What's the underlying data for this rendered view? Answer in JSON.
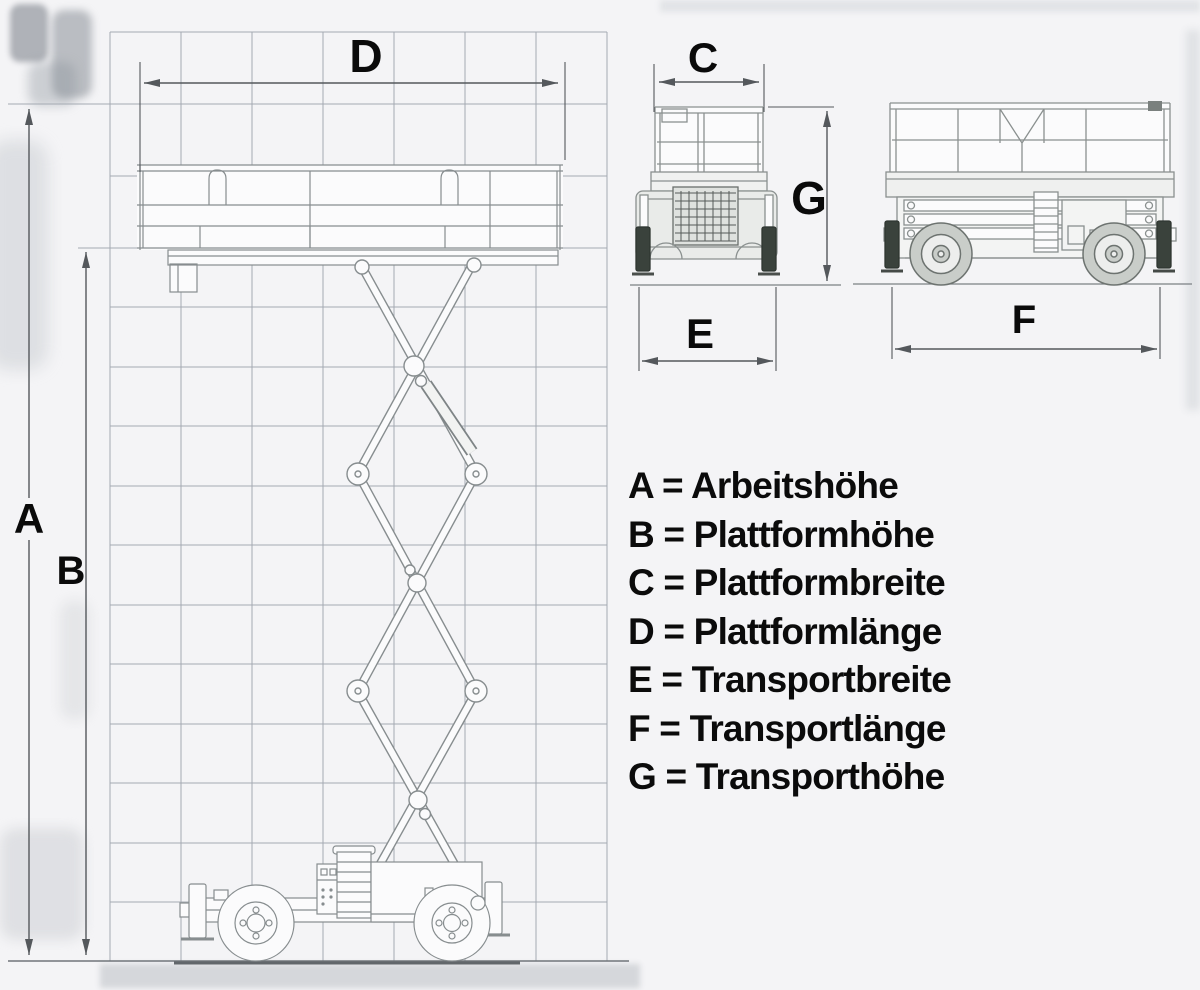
{
  "diagram": {
    "dimension_labels": {
      "A": "A",
      "B": "B",
      "C": "C",
      "D": "D",
      "E": "E",
      "F": "F",
      "G": "G"
    },
    "legend": {
      "items": [
        {
          "letter": "A",
          "name": "Arbeitshöhe",
          "text": "A = Arbeitshöhe"
        },
        {
          "letter": "B",
          "name": "Plattformhöhe",
          "text": "B = Plattformhöhe"
        },
        {
          "letter": "C",
          "name": "Plattformbreite",
          "text": "C = Plattformbreite"
        },
        {
          "letter": "D",
          "name": "Plattformlänge",
          "text": "D = Plattformlänge"
        },
        {
          "letter": "E",
          "name": "Transportbreite",
          "text": "E = Transportbreite"
        },
        {
          "letter": "F",
          "name": "Transportlänge",
          "text": "F = Transportlänge"
        },
        {
          "letter": "G",
          "name": "Transporthöhe",
          "text": "G = Transporthöhe"
        }
      ]
    },
    "colors": {
      "background": "#f4f4f6",
      "grid_line": "#a4aab2",
      "machine_line": "#878d8f",
      "dimension_line": "#54585c",
      "label_text": "#0a0a0a",
      "jack_pad": "#3a423c"
    }
  }
}
